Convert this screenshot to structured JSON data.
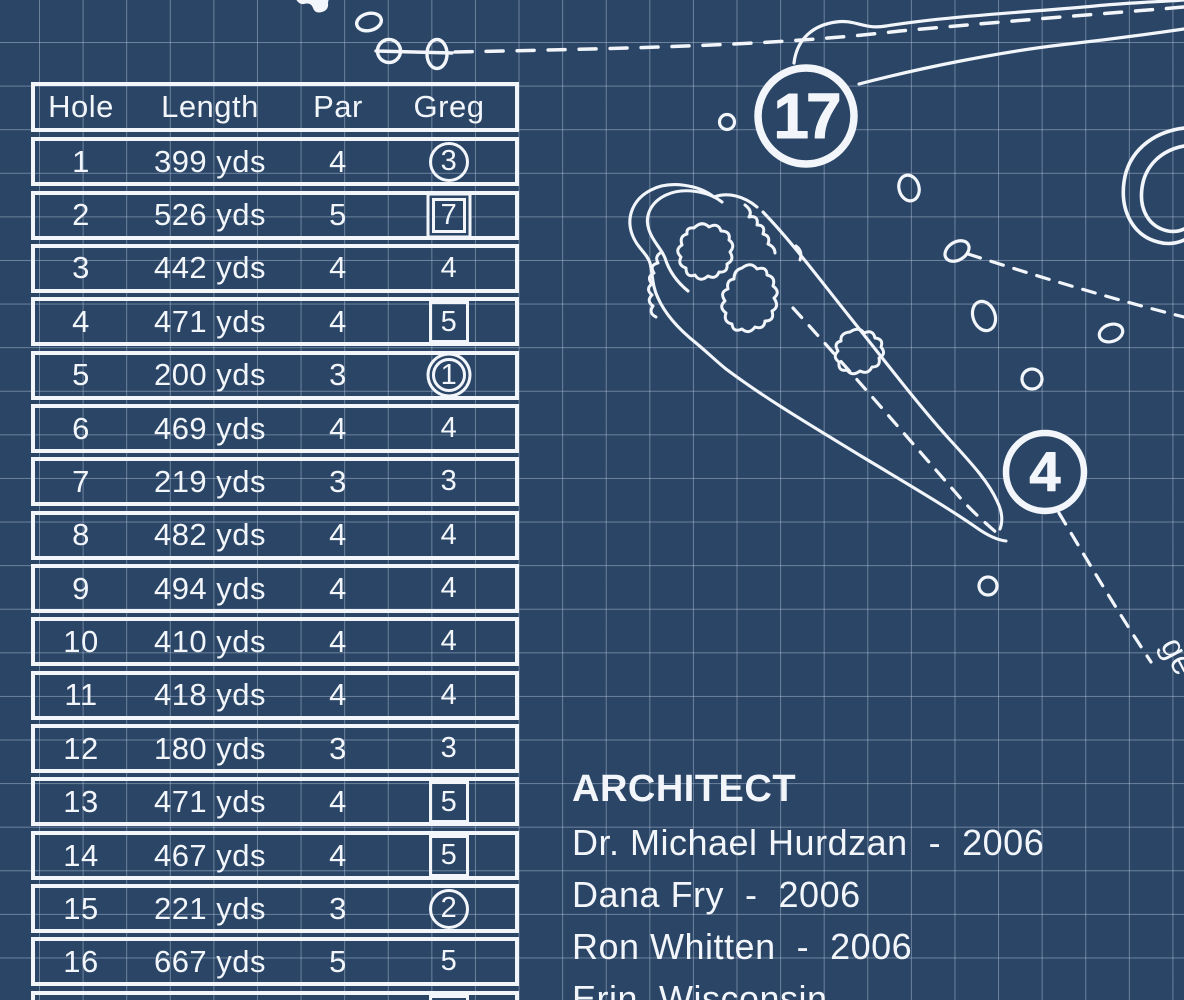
{
  "scorecard": {
    "headers": [
      "Hole",
      "Length",
      "Par",
      "Greg"
    ],
    "rows": [
      {
        "hole": "1",
        "length": "399 yds",
        "par": "4",
        "greg": "3",
        "marker": "circle"
      },
      {
        "hole": "2",
        "length": "526 yds",
        "par": "5",
        "greg": "7",
        "marker": "double-square"
      },
      {
        "hole": "3",
        "length": "442 yds",
        "par": "4",
        "greg": "4",
        "marker": "none"
      },
      {
        "hole": "4",
        "length": "471 yds",
        "par": "4",
        "greg": "5",
        "marker": "square"
      },
      {
        "hole": "5",
        "length": "200 yds",
        "par": "3",
        "greg": "1",
        "marker": "double-circle"
      },
      {
        "hole": "6",
        "length": "469 yds",
        "par": "4",
        "greg": "4",
        "marker": "none"
      },
      {
        "hole": "7",
        "length": "219 yds",
        "par": "3",
        "greg": "3",
        "marker": "none"
      },
      {
        "hole": "8",
        "length": "482 yds",
        "par": "4",
        "greg": "4",
        "marker": "none"
      },
      {
        "hole": "9",
        "length": "494 yds",
        "par": "4",
        "greg": "4",
        "marker": "none"
      },
      {
        "hole": "10",
        "length": "410 yds",
        "par": "4",
        "greg": "4",
        "marker": "none"
      },
      {
        "hole": "11",
        "length": "418 yds",
        "par": "4",
        "greg": "4",
        "marker": "none"
      },
      {
        "hole": "12",
        "length": "180 yds",
        "par": "3",
        "greg": "3",
        "marker": "none"
      },
      {
        "hole": "13",
        "length": "471 yds",
        "par": "4",
        "greg": "5",
        "marker": "square"
      },
      {
        "hole": "14",
        "length": "467 yds",
        "par": "4",
        "greg": "5",
        "marker": "square"
      },
      {
        "hole": "15",
        "length": "221 yds",
        "par": "3",
        "greg": "2",
        "marker": "circle"
      },
      {
        "hole": "16",
        "length": "667 yds",
        "par": "5",
        "greg": "5",
        "marker": "none"
      },
      {
        "hole": "",
        "length": "",
        "par": "",
        "greg": "",
        "marker": "square"
      }
    ]
  },
  "map": {
    "hole_markers": [
      {
        "number": "17"
      },
      {
        "number": "4"
      }
    ],
    "partial_label": "ge"
  },
  "architect": {
    "heading": "ARCHITECT",
    "lines": [
      "Dr. Michael Hurdzan  -  2006",
      "Dana Fry  -  2006",
      "Ron Whitten  -  2006",
      "Erin, Wisconsin"
    ]
  },
  "colors": {
    "background": "#2a4566",
    "grid_line": "#becce0",
    "ink": "#f2f6fa"
  }
}
